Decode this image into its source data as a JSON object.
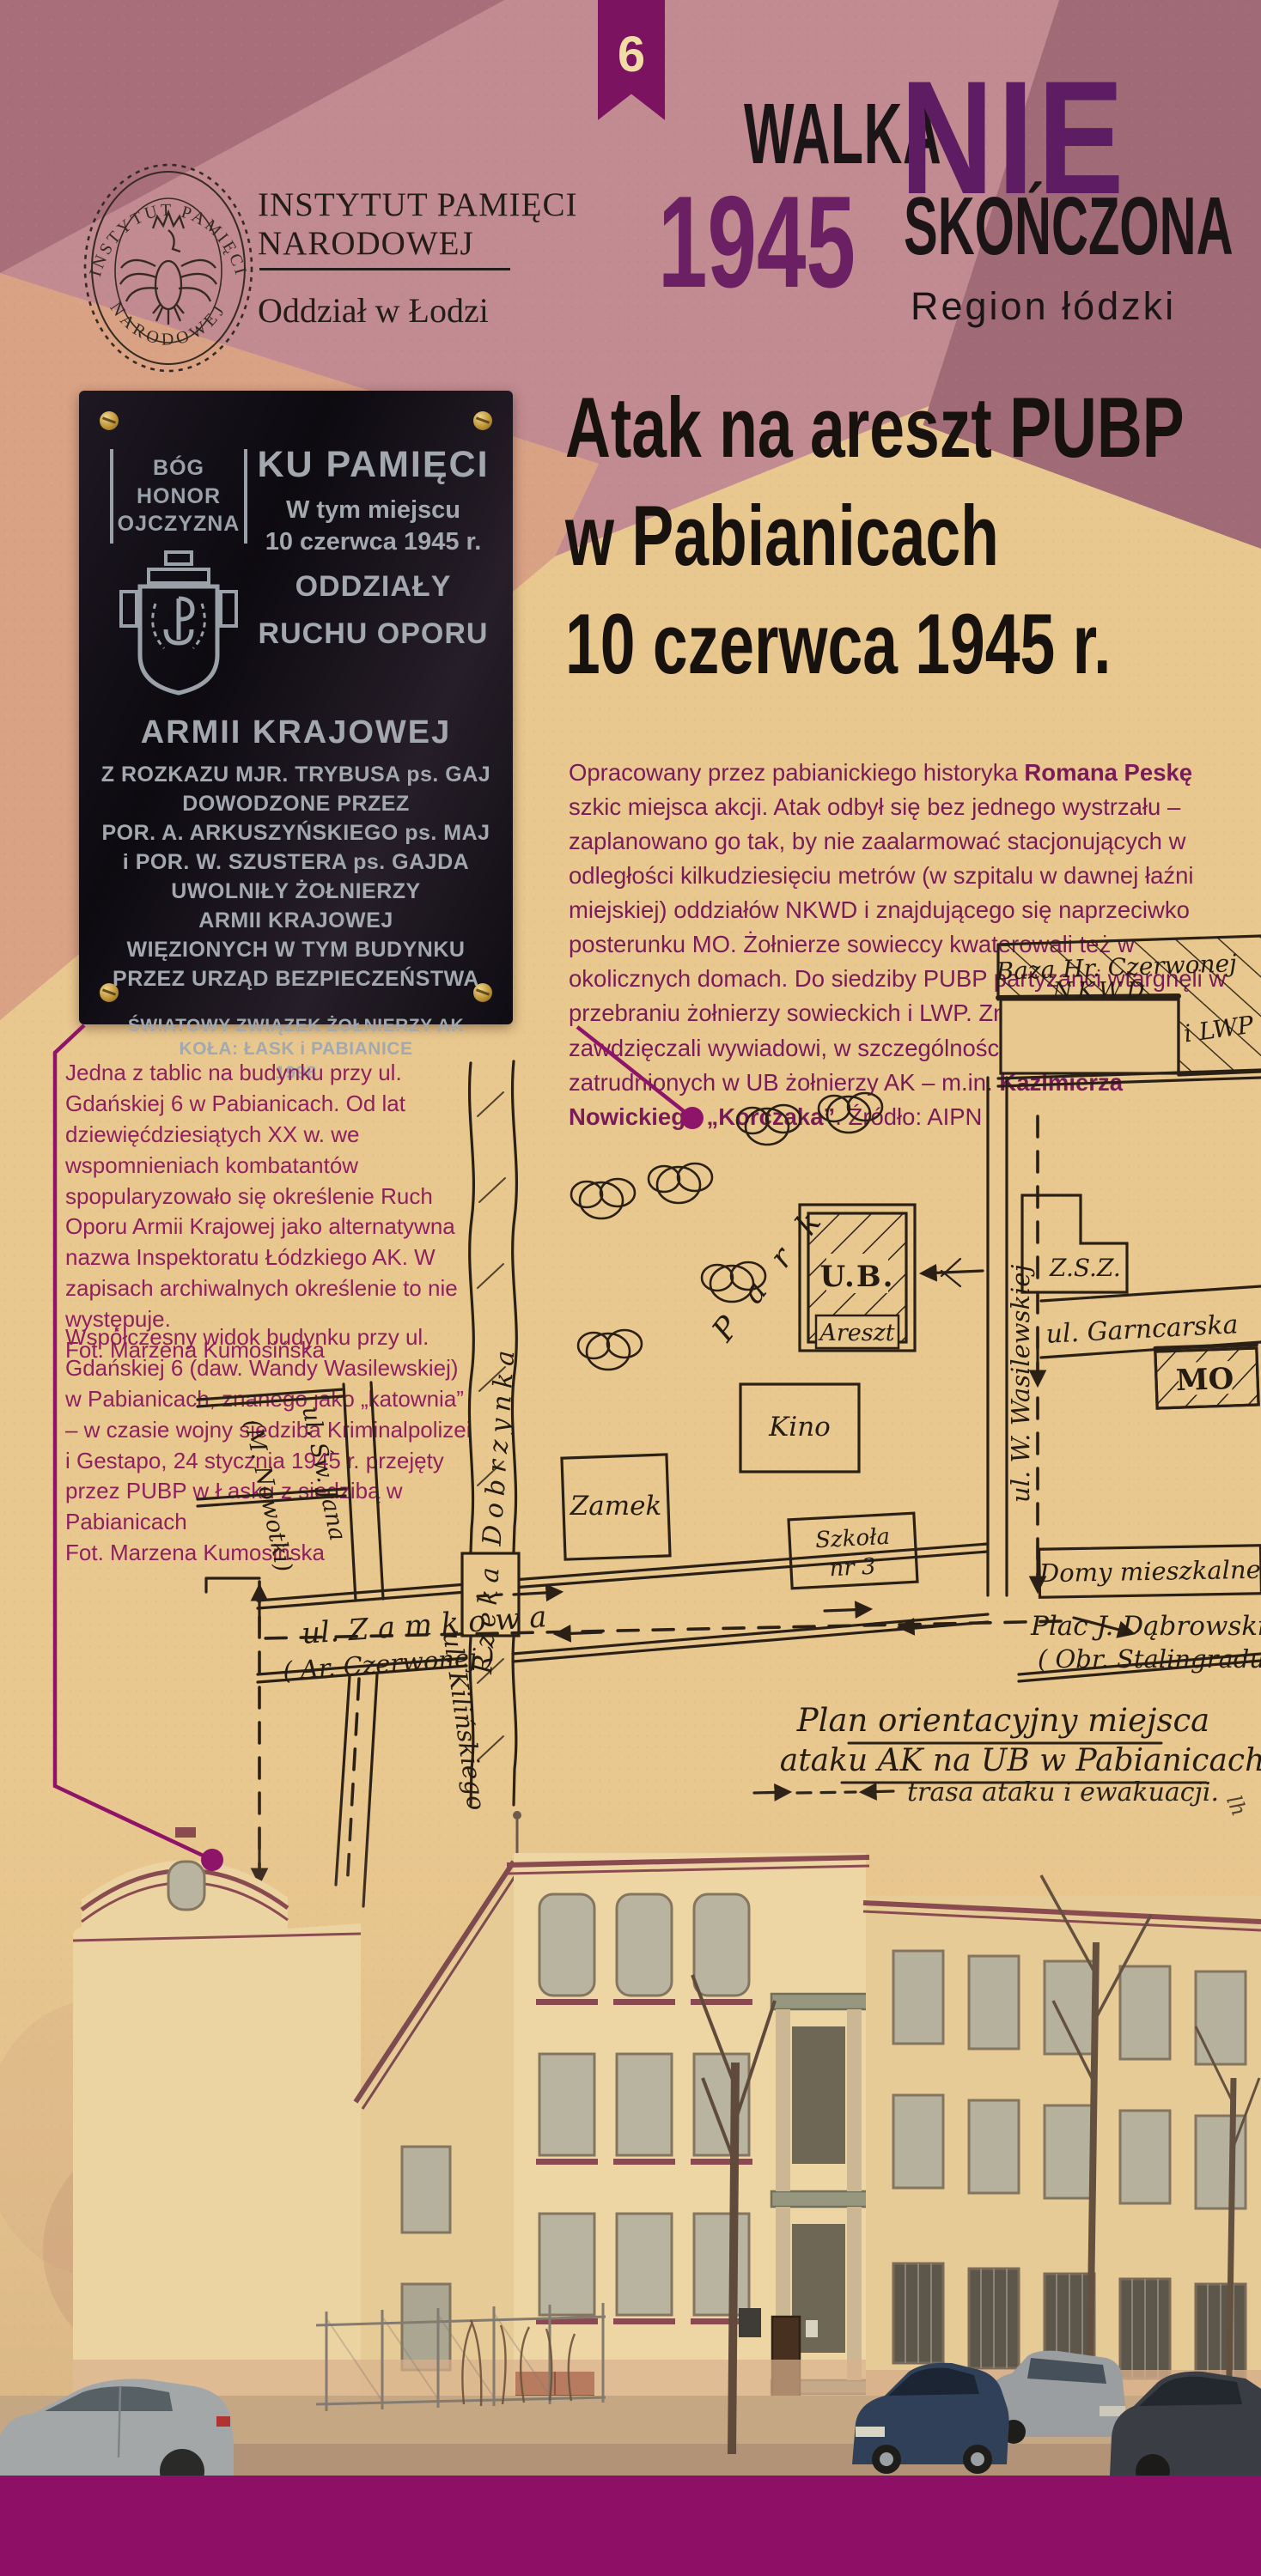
{
  "page": {
    "number": "6"
  },
  "masthead": {
    "walka": "WALKA",
    "nie": "NIE",
    "year": "1945",
    "skonczona": "SKOŃCZONA",
    "region": "Region łódzki"
  },
  "ipn": {
    "seal_top": "INSTYTUT PAMIĘCI",
    "seal_bottom": "NARODOWEJ",
    "name1": "INSTYTUT PAMIĘCI",
    "name2": "NARODOWEJ",
    "branch": "Oddział w Łodzi"
  },
  "plaque": {
    "badge": {
      "word1": "BÓG",
      "word2": "HONOR",
      "word3": "OJCZYZNA"
    },
    "title": "KU PAMIĘCI",
    "sub1": "W tym miejscu",
    "sub2": "10 czerwca 1945 r.",
    "mid1": "ODDZIAŁY",
    "mid2": "RUCHU OPORU",
    "mid3": "ARMII KRAJOWEJ",
    "body1": "Z ROZKAZU MJR. TRYBUSA ps. GAJ",
    "body2": "DOWODZONE PRZEZ",
    "body3": "POR. A. ARKUSZYŃSKIEGO ps. MAJ",
    "body4": "i POR. W. SZUSTERA ps. GAJDA",
    "body5": "UWOLNIŁY ŻOŁNIERZY",
    "body6": "ARMII KRAJOWEJ",
    "body7": "WIĘZIONYCH W TYM  BUDYNKU",
    "body8": "PRZEZ  URZĄD BEZPIECZEŃSTWA",
    "f1": "ŚWIATOWY ZWIĄZEK ŻOŁNIERZY AK",
    "f2": "KOŁA: ŁASK i PABIANICE",
    "f3": "1998"
  },
  "heading": {
    "line1": "Atak na areszt PUBP",
    "line2": "w Pabianicach",
    "line3": "10 czerwca 1945 r."
  },
  "lead": {
    "segments": [
      {
        "t": "Opracowany przez pabianickiego historyka "
      },
      {
        "t": "Romana Peskę"
      },
      {
        "t": " szkic miejsca akcji. Atak odbył się bez jednego wystrzału – zaplanowano go tak, by nie zaalarmować stacjonujących w odległości kilkudziesięciu metrów (w szpitalu w dawnej łaźni miejskiej) oddziałów NKWD i znajdującego się naprzeciwko posterunku MO. Żołnierze sowieccy kwaterowali też w okolicznych domach. Do siedziby PUBP partyzanci wtargnęli w przebraniu żołnierzy sowieckich i LWP. Znajomość terenu zawdzięczali wywiadowi, w szczególności informacjom od zatrudnionych w UB żołnierzy AK – m.in. "
      },
      {
        "t": "Kazimierza Nowickiego „Korczaka”"
      },
      {
        "t": ". Źródło: AIPN"
      }
    ]
  },
  "captions": {
    "c1_text": "Jedna z tablic na budynku przy ul. Gdańskiej 6 w Pabianicach. Od lat dziewięćdziesiątych XX w. we wspomnieniach kombatantów spopularyzowało się określenie Ruch Oporu Armii Krajowej jako alternatywna nazwa Inspektoratu Łódzkiego AK. W zapisach archiwalnych określenie to nie występuje.",
    "c1_credit": "Fot. Marzena Kumosińska",
    "c2_text": "Współczesny widok budynku przy ul. Gdańskiej 6 (daw. Wandy Wasilewskiej) w Pabianicach, znanego jako „katownia” – w czasie wojny siedziba Kriminalpolizei i Gestapo, 24 stycznia 1945 r. przejęty przez PUBP w Łasku z siedzibą w Pabianicach",
    "c2_credit": "Fot. Marzena Kumosińska"
  },
  "map": {
    "baza1": "Baza Hr. Czerwonej",
    "baza2": "NKWD",
    "lwp": "i LWP",
    "zsz": "Z.S.Z.",
    "garncarska": "ul. Garncarska",
    "mo": "MO",
    "ub": "U.B.",
    "areszt": "Areszt",
    "park": "P a r k",
    "kino": "Kino",
    "zamek": "Zamek",
    "szkola1": "Szkoła",
    "szkola2": "nr 3",
    "wasilewskiej": "ul. W. Wasilewskiej",
    "zamkowa1": "ul. Z a m k o w a",
    "zamkowa2": "( Ar. Czerwonej )",
    "rzeka": "Rzeka Dobrzynka",
    "swjana1": "ul. Św. Jana",
    "swjana2": "(M. Nowotki)",
    "kilinskiego": "ul. Kilińskiego",
    "domy": "Domy mieszkalne",
    "plac1": "Plac J. Dąbrowskiego",
    "plac2": "( Obr. Stalingradu )",
    "plan1": "Plan orientacyjny miejsca",
    "plan2": "ataku AK na UB w Pabianicach",
    "legend": "trasa ataku i ewakuacji.",
    "signature": "lh"
  },
  "colors": {
    "paper": "#e9c88f",
    "rose": "#c18b91",
    "mauve": "#a86f7a",
    "salmon": "#d9a285",
    "accent_purple": "#8d1468",
    "bottom_bar": "#8d1066",
    "lead_text": "#7a1b59",
    "caption_text": "#8e2060",
    "map_ink": "#2b2016",
    "plaque_silver": "#a2a8ae"
  }
}
